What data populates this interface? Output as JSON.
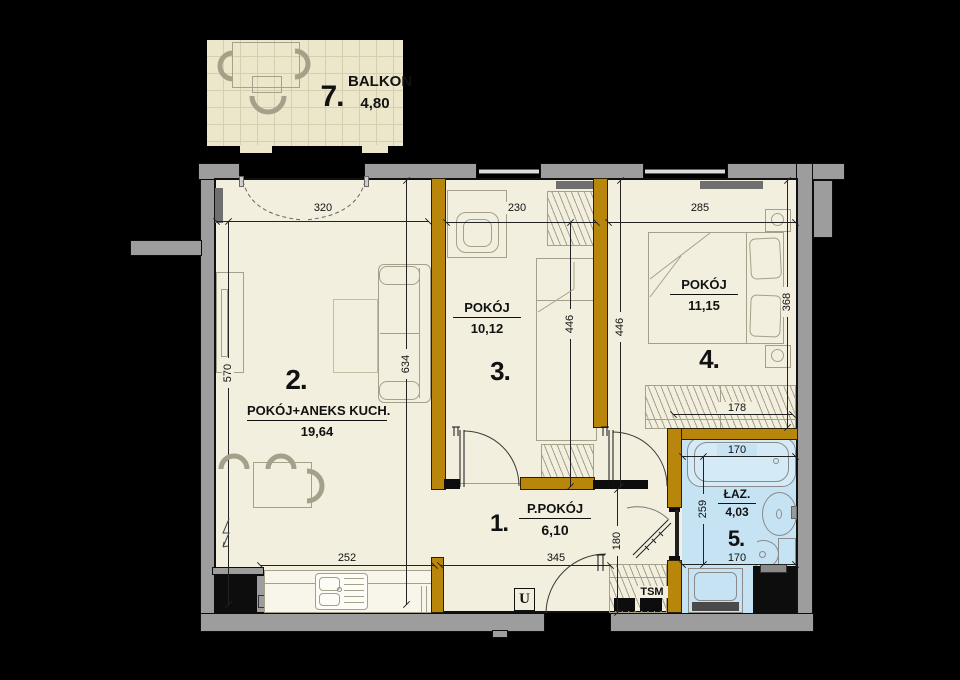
{
  "rooms": {
    "balcony": {
      "number": "7.",
      "name": "BALKON",
      "area": "4,80"
    },
    "living": {
      "number": "2.",
      "name": "POKÓJ+ANEKS KUCH.",
      "area": "19,64"
    },
    "room3": {
      "number": "3.",
      "name": "POKÓJ",
      "area": "10,12"
    },
    "room4": {
      "number": "4.",
      "name": "POKÓJ",
      "area": "11,15"
    },
    "hall": {
      "number": "1.",
      "name": "P.POKÓJ",
      "area": "6,10"
    },
    "bath": {
      "number": "5.",
      "name": "ŁAZ.",
      "area": "4,03"
    }
  },
  "dims": {
    "living_top": "320",
    "living_left": "570",
    "living_right": "634",
    "room3_top": "230",
    "room3_right": "446",
    "room4_left": "446",
    "room4_top": "285",
    "room4_right": "368",
    "room4_wardrobe": "178",
    "bath_top": "170",
    "bath_left": "259",
    "bath_bottom": "170",
    "hall_width": "345",
    "hall_depth": "180",
    "kitchen_counter": "252"
  },
  "labels": {
    "entrance_marker": "U",
    "shaft_label": "TSM"
  },
  "colors": {
    "floor": "#f3efdf",
    "bath_floor": "#c6e3f3",
    "balcony_floor": "#ece7cb",
    "balcony_grid": "#d5cfb2",
    "wall_exterior": "#9d9d9d",
    "wall_interior": "#b8860b"
  }
}
